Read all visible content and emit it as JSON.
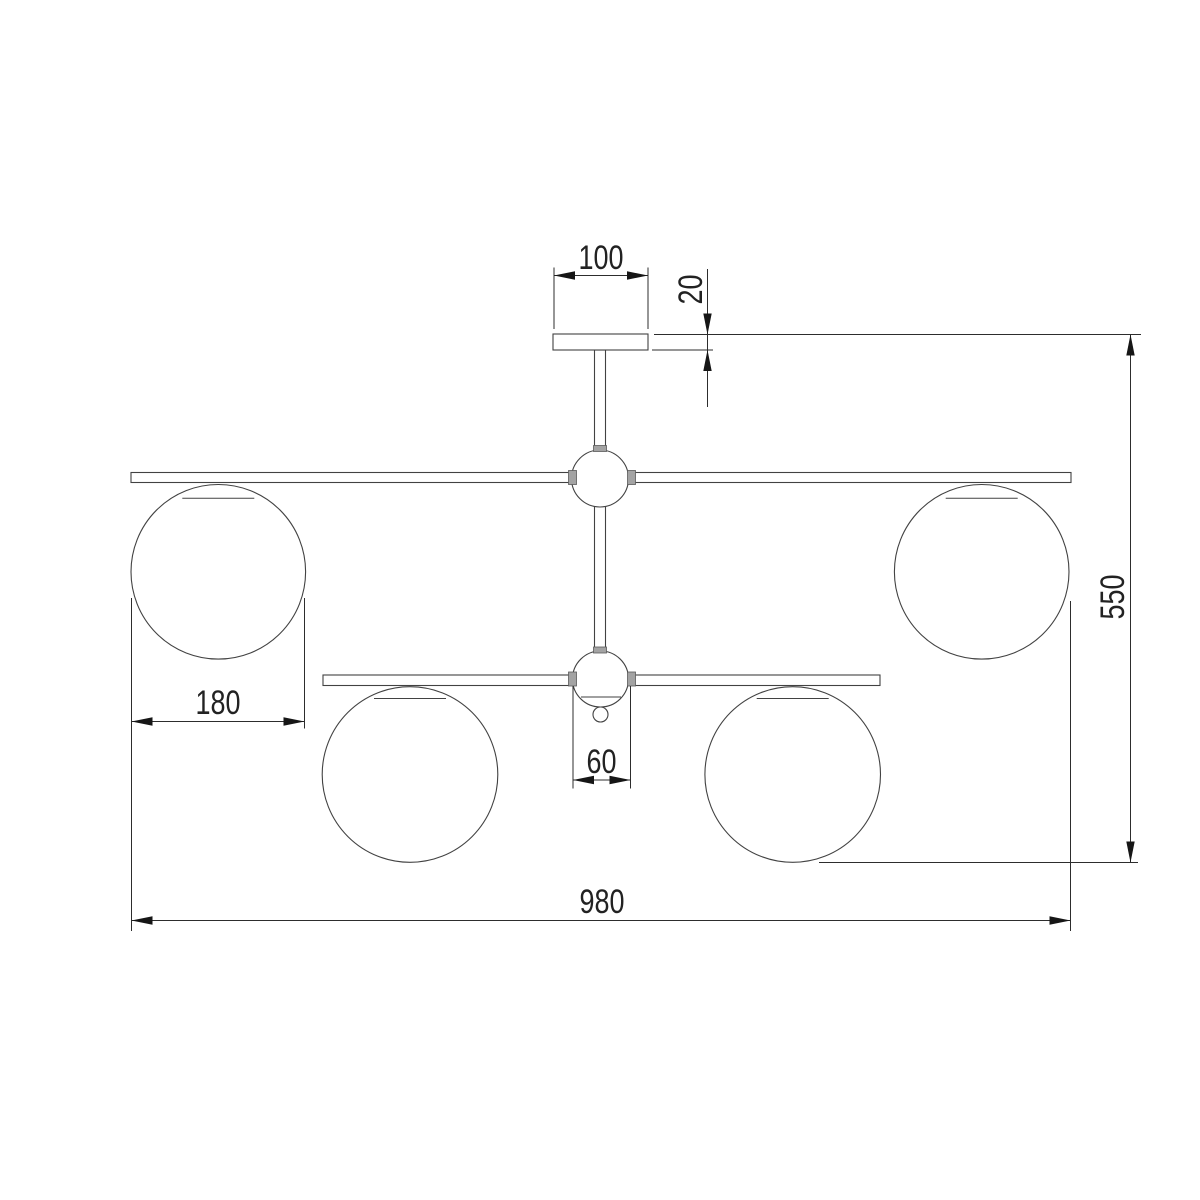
{
  "drawing": {
    "type": "technical-dimension-drawing",
    "subject": "ceiling chandelier with four globe shades, front elevation",
    "background": "#ffffff"
  },
  "colors": {
    "background": "#ffffff",
    "outline": "#424242",
    "dimension": "#2d2d2d",
    "arrow": "#161616",
    "text": "#222222",
    "connector_fill": "#a3a3a3"
  },
  "labels": {
    "canopy_width": "100",
    "canopy_thickness": "20",
    "overall_height": "550",
    "overall_width": "980",
    "globe_diameter": "180",
    "hub_diameter": "60"
  },
  "geometry": {
    "fixture": [
      {
        "kind": "circle",
        "name": "globe-upper-left",
        "cx": 218.3,
        "cy": 571.8,
        "r": 87.3,
        "cls": "outline"
      },
      {
        "kind": "circle",
        "name": "globe-upper-right",
        "cx": 981.7,
        "cy": 571.8,
        "r": 87.3,
        "cls": "outline"
      },
      {
        "kind": "circle",
        "name": "globe-lower-left",
        "cx": 410,
        "cy": 774.5,
        "r": 87.8,
        "cls": "outline"
      },
      {
        "kind": "circle",
        "name": "globe-lower-right",
        "cx": 792.7,
        "cy": 774.5,
        "r": 87.8,
        "cls": "outline"
      },
      {
        "kind": "rect",
        "name": "arm-bar-upper",
        "x": 131,
        "y": 472.5,
        "w": 940,
        "h": 10,
        "cls": "outline"
      },
      {
        "kind": "rect",
        "name": "arm-bar-lower",
        "x": 323,
        "y": 675,
        "w": 557,
        "h": 10.5,
        "cls": "outline"
      },
      {
        "kind": "line",
        "name": "globe-upper-left-cap-line",
        "x1": 182.3,
        "y1": 498.3,
        "x2": 254.3,
        "y2": 498.3,
        "cls": "thin"
      },
      {
        "kind": "line",
        "name": "globe-upper-right-cap-line",
        "x1": 945.7,
        "y1": 498.3,
        "x2": 1017.7,
        "y2": 498.3,
        "cls": "thin"
      },
      {
        "kind": "line",
        "name": "globe-lower-left-cap-line",
        "x1": 374,
        "y1": 698.5,
        "x2": 446,
        "y2": 698.5,
        "cls": "thin"
      },
      {
        "kind": "line",
        "name": "globe-lower-right-cap-line",
        "x1": 756.7,
        "y1": 698.5,
        "x2": 828.7,
        "y2": 698.5,
        "cls": "thin"
      },
      {
        "kind": "rect",
        "name": "stem-upper",
        "x": 594.5,
        "y": 350,
        "w": 11,
        "h": 101,
        "cls": "outline"
      },
      {
        "kind": "rect",
        "name": "stem-middle",
        "x": 594.5,
        "y": 505,
        "w": 11,
        "h": 148,
        "cls": "outline"
      },
      {
        "kind": "rect",
        "name": "canopy-plate",
        "x": 553,
        "y": 334,
        "w": 95,
        "h": 16,
        "cls": "outline"
      },
      {
        "kind": "circle",
        "name": "hub-ball-upper",
        "cx": 600,
        "cy": 478.5,
        "r": 28.5,
        "cls": "outline"
      },
      {
        "kind": "circle",
        "name": "hub-ball-lower",
        "cx": 600.5,
        "cy": 679,
        "r": 28,
        "cls": "outline"
      },
      {
        "kind": "line",
        "name": "hub-lower-chord-line",
        "x1": 581,
        "y1": 697,
        "x2": 621,
        "y2": 697,
        "cls": "thin"
      },
      {
        "kind": "circle",
        "name": "finial-knob",
        "cx": 600.5,
        "cy": 714.5,
        "r": 7.5,
        "cls": "outline"
      },
      {
        "kind": "rect",
        "name": "connector-upper-hub-left",
        "x": 568.5,
        "y": 470.5,
        "w": 8,
        "h": 14,
        "cls": "nub"
      },
      {
        "kind": "rect",
        "name": "connector-upper-hub-right",
        "x": 627.5,
        "y": 470.5,
        "w": 8,
        "h": 14,
        "cls": "nub"
      },
      {
        "kind": "rect",
        "name": "connector-upper-hub-top",
        "x": 593.5,
        "y": 445.5,
        "w": 13,
        "h": 6,
        "cls": "nub"
      },
      {
        "kind": "rect",
        "name": "connector-lower-hub-left",
        "x": 568.5,
        "y": 672,
        "w": 8,
        "h": 14,
        "cls": "nub"
      },
      {
        "kind": "rect",
        "name": "connector-lower-hub-right",
        "x": 627.5,
        "y": 672,
        "w": 8,
        "h": 14,
        "cls": "nub"
      },
      {
        "kind": "rect",
        "name": "connector-lower-hub-top",
        "x": 593.5,
        "y": 647,
        "w": 13,
        "h": 6,
        "cls": "nub"
      }
    ],
    "dimensions": [
      {
        "name": "dim-canopy-width",
        "label": "canopy_width",
        "ext": [
          [
            554,
            267.5,
            554,
            329
          ],
          [
            648,
            267.5,
            648,
            329
          ]
        ],
        "line": [
          554,
          275.5,
          648,
          275.5
        ],
        "arrows": [
          [
            "left",
            554,
            275.5
          ],
          [
            "right",
            648,
            275.5
          ]
        ],
        "text": [
          601,
          269,
          0
        ]
      },
      {
        "name": "dim-canopy-thickness",
        "label": "canopy_thickness",
        "ext": [
          [
            654,
            334.5,
            1141,
            334.5
          ],
          [
            652,
            350,
            713,
            350
          ]
        ],
        "line": [
          707.5,
          269,
          707.5,
          407
        ],
        "arrows": [
          [
            "down",
            707.5,
            334.5
          ],
          [
            "up",
            707.5,
            350
          ]
        ],
        "text": [
          702,
          289.5,
          -90
        ]
      },
      {
        "name": "dim-overall-height",
        "label": "overall_height",
        "ext": [
          [
            819,
            862.5,
            1138,
            862.5
          ]
        ],
        "line": [
          1130.5,
          334.5,
          1130.5,
          862.5
        ],
        "arrows": [
          [
            "up",
            1130.5,
            334.5
          ],
          [
            "down",
            1130.5,
            862.5
          ]
        ],
        "text": [
          1124,
          597,
          -90
        ]
      },
      {
        "name": "dim-overall-width",
        "label": "overall_width",
        "ext": [
          [
            131.5,
            598,
            131.5,
            931
          ],
          [
            1070.5,
            601,
            1070.5,
            931
          ]
        ],
        "line": [
          131.5,
          920.5,
          1070.5,
          920.5
        ],
        "arrows": [
          [
            "left",
            131.5,
            920.5
          ],
          [
            "right",
            1070.5,
            920.5
          ]
        ],
        "text": [
          602,
          913,
          0
        ]
      },
      {
        "name": "dim-globe-diameter",
        "label": "globe_diameter",
        "ext": [
          [
            304.5,
            598,
            304.5,
            728.5
          ]
        ],
        "line": [
          131.5,
          721.5,
          304.5,
          721.5
        ],
        "arrows": [
          [
            "left",
            131.5,
            721.5
          ],
          [
            "right",
            304.5,
            721.5
          ]
        ],
        "text": [
          218,
          714,
          0
        ]
      },
      {
        "name": "dim-hub-diameter",
        "label": "hub_diameter",
        "ext": [
          [
            573,
            686,
            573,
            788.5
          ],
          [
            630.5,
            686,
            630.5,
            788.5
          ]
        ],
        "line": [
          573,
          780,
          630.5,
          780
        ],
        "arrows": [
          [
            "left",
            573,
            780
          ],
          [
            "right",
            630.5,
            780
          ]
        ],
        "text": [
          601.5,
          773,
          0
        ]
      }
    ]
  }
}
